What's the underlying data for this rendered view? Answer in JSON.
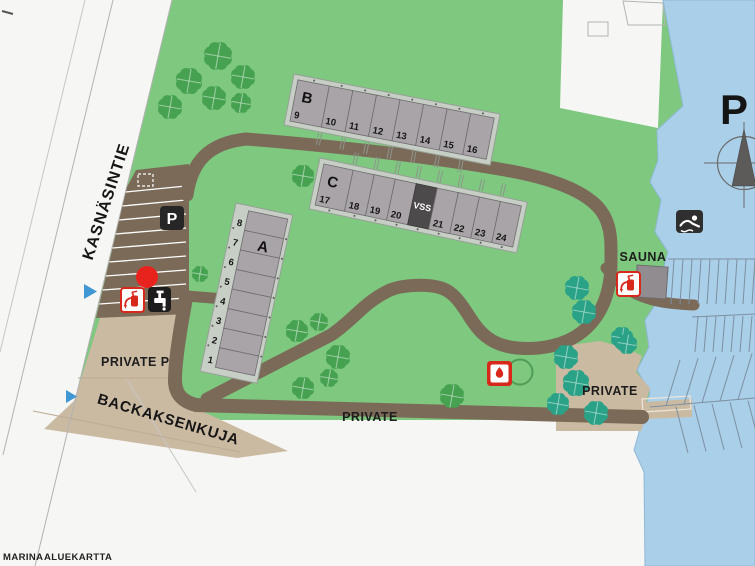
{
  "footer": {
    "word1": "MARINA",
    "word2": "ALUEKARTTA"
  },
  "roads": {
    "kasnasintie": "KASNÄSINTIE",
    "backaksenkuja": "BACKAKSENKUJA",
    "private_road": "PRIVATE"
  },
  "areas": {
    "private_parking": "PRIVATE P",
    "private_right": "PRIVATE",
    "sauna": "SAUNA"
  },
  "marina": {
    "guest_parking_label": "P"
  },
  "parking": {
    "sign_label": "P"
  },
  "buildings": {
    "a": {
      "label": "A",
      "units": [
        "1",
        "2",
        "3",
        "4",
        "5",
        "6",
        "7",
        "8"
      ]
    },
    "b": {
      "label": "B",
      "units": [
        "9",
        "10",
        "11",
        "12",
        "13",
        "14",
        "15",
        "16"
      ]
    },
    "c": {
      "label": "C",
      "units": [
        "17",
        "18",
        "19",
        "20",
        "21",
        "22",
        "23",
        "24"
      ],
      "shelter": "VSS"
    }
  },
  "icons": {
    "parking_sign": "parking-sign-icon",
    "fire_extinguisher": "fire-extinguisher-icon",
    "water_tap": "water-tap-icon",
    "campfire": "campfire-icon",
    "swimming": "swimming-icon",
    "compass_north": "compass-north-icon",
    "tree": "tree-icon",
    "shrub": "shrub-icon",
    "direction_marker": "direction-marker-icon",
    "red_point": "red-point-marker"
  },
  "colors": {
    "green": "#7ec97f",
    "water": "#a9cfe9",
    "road": "#7b6a58",
    "sand": "#cbbaa2",
    "building_unit": "#a8a4a7",
    "building_pad": "#c7cec5",
    "shelter": "#4d4a4b",
    "accent_red": "#d8281c",
    "sauna_label": "#8a2703",
    "tree_green": "#46a251",
    "tree_teal": "#2aa287",
    "marker_blue": "#3f97d3"
  }
}
